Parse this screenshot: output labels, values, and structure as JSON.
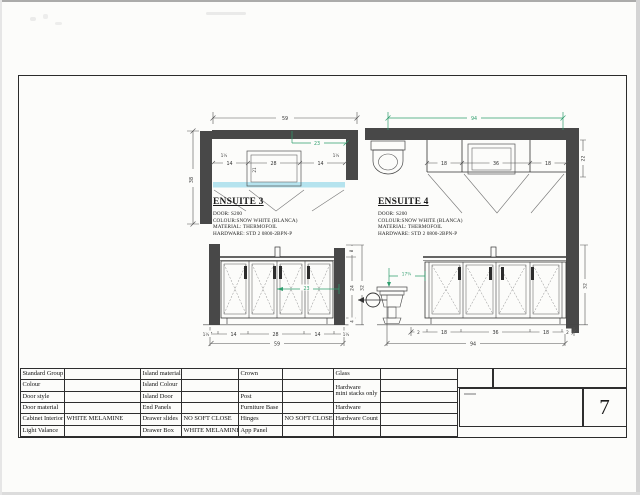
{
  "page": {
    "number": "7"
  },
  "ensuite3": {
    "title": "ENSUITE 3",
    "specs": [
      "DOOR: S200",
      "COLOUR:SNOW WHITE (BLANCA)",
      "MATERIAL: THERMOFOIL",
      "HARDWARE: STD 2 0800-2BPN-P"
    ],
    "plan": {
      "total_width": "59",
      "total_height": "38",
      "seg_left": "14",
      "seg_center": "28",
      "seg_right": "14",
      "filler_left": "1½",
      "filler_right": "1½",
      "sink_depth": "21",
      "green": "23"
    },
    "elev": {
      "filler_left": "1½",
      "seg_left": "14",
      "seg_center": "28",
      "seg_right": "14",
      "filler_right": "1½",
      "total": "59",
      "green": "23",
      "splash": "8",
      "cab_height": "24",
      "toe": "4",
      "total_height": "32"
    }
  },
  "ensuite4": {
    "title": "ENSUITE 4",
    "specs": [
      "DOOR: S200",
      "COLOUR:SNOW WHITE (BLANCA)",
      "MATERIAL: THERMOFOIL",
      "HARDWARE: STD 2 0800-2BPN-P"
    ],
    "plan": {
      "total_width": "94",
      "depth": "22",
      "seg_left": "18",
      "seg_center": "36",
      "seg_right": "18"
    },
    "elev": {
      "filler_left": "2",
      "seg_left": "18",
      "seg_center": "36",
      "seg_right": "18",
      "filler_right": "2",
      "total": "94",
      "toilet_offset": "17¾",
      "total_height": "32"
    }
  },
  "table": {
    "rows": [
      {
        "c0": "Standard Group",
        "c1": "",
        "c2": "Island material",
        "c3": "",
        "c4": "Crown",
        "c5": "",
        "c6": "Glass",
        "c7": ""
      },
      {
        "c0": "Colour",
        "c1": "",
        "c2": "Island Colour",
        "c3": "",
        "c4": "",
        "c5": "",
        "c6": "Hardware",
        "c6b": "mini stacks only",
        "c7": ""
      },
      {
        "c0": "Door style",
        "c1": "",
        "c2": "Island Door",
        "c3": "",
        "c4": "Post",
        "c5": "",
        "c7": ""
      },
      {
        "c0": "Door material",
        "c1": "",
        "c2": "End Panels",
        "c3": "",
        "c4": "Furniture Base",
        "c5": "",
        "c6": "Hardware",
        "c7": ""
      },
      {
        "c0": "Cabinet Interior",
        "c1": "WHITE MELAMINE",
        "c2": "Drawer slides",
        "c3": "NO SOFT CLOSE",
        "c4": "Hinges",
        "c5": "NO SOFT CLOSE",
        "c6": "Hardware Count",
        "c7": ""
      },
      {
        "c0": "Light Valance",
        "c1": "",
        "c2": "Drawer Box",
        "c3": "WHITE MELAMINE",
        "c4": "App Panel",
        "c5": "",
        "c6": "",
        "c7": ""
      }
    ]
  },
  "colors": {
    "accent_green": "#2f9e6e",
    "counter_cyan": "#b5e3ee",
    "wall_fill": "#484848"
  }
}
